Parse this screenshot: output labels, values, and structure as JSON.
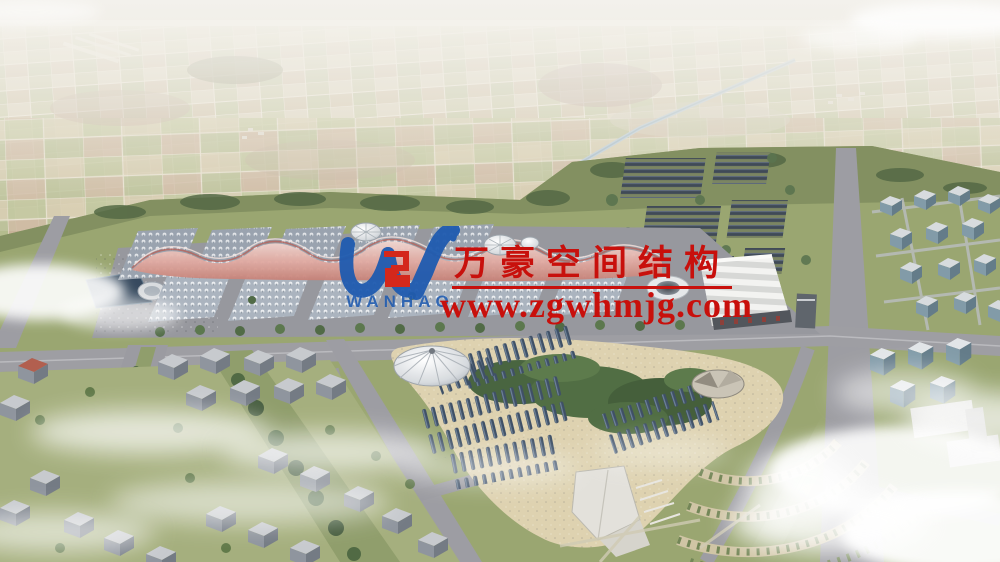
{
  "watermark": {
    "company": "万豪空间结构",
    "website": "www.zgwhmjg.com",
    "logo_text": "WANHAO"
  },
  "colors": {
    "watermark_red": "#c8100c",
    "logo_blue": "#1f5bb0",
    "emblem_red": "#d4281c"
  },
  "icons": {
    "logo": "wanhao-monogram"
  }
}
